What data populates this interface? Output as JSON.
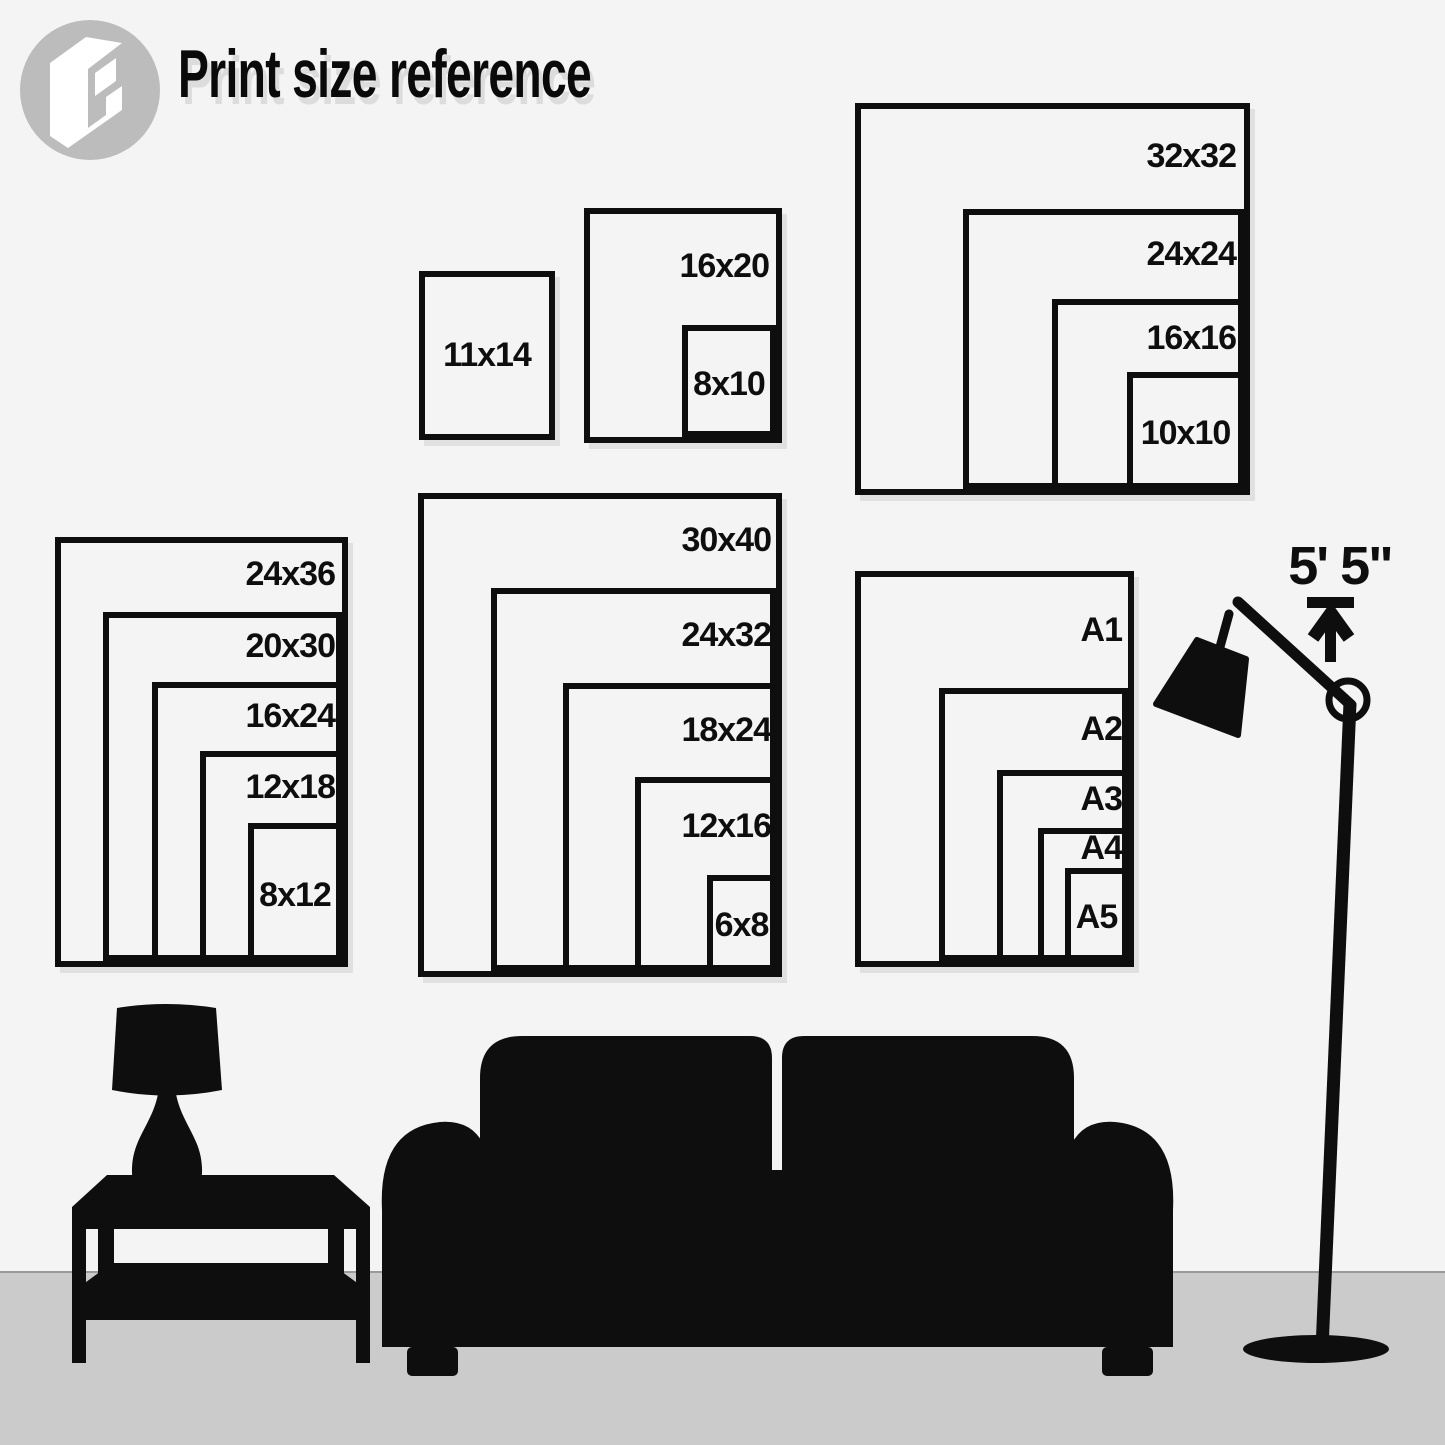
{
  "title": "Print size reference",
  "logo": {
    "name": "displate-frame-logo"
  },
  "height_marker": {
    "label": "5' 5\""
  },
  "groups": {
    "single": {
      "sizes": [
        "11x14"
      ]
    },
    "pair": {
      "sizes": [
        "16x20",
        "8x10"
      ]
    },
    "square": {
      "sizes": [
        "32x32",
        "24x24",
        "16x16",
        "10x10"
      ]
    },
    "poster": {
      "sizes": [
        "24x36",
        "20x30",
        "16x24",
        "12x18",
        "8x12"
      ]
    },
    "large": {
      "sizes": [
        "30x40",
        "24x32",
        "18x24",
        "12x16",
        "6x8"
      ]
    },
    "a_series": {
      "sizes": [
        "A1",
        "A2",
        "A3",
        "A4",
        "A5"
      ]
    }
  },
  "scene": {
    "furniture": [
      "table-lamp",
      "coffee-table",
      "sofa",
      "floor-lamp"
    ]
  },
  "colors": {
    "bg": "#f4f4f5",
    "floor": "#cbcbcb",
    "line": "#0e0e0e",
    "logo": "#bcbcbc",
    "shadow": "#dcdcdc"
  }
}
